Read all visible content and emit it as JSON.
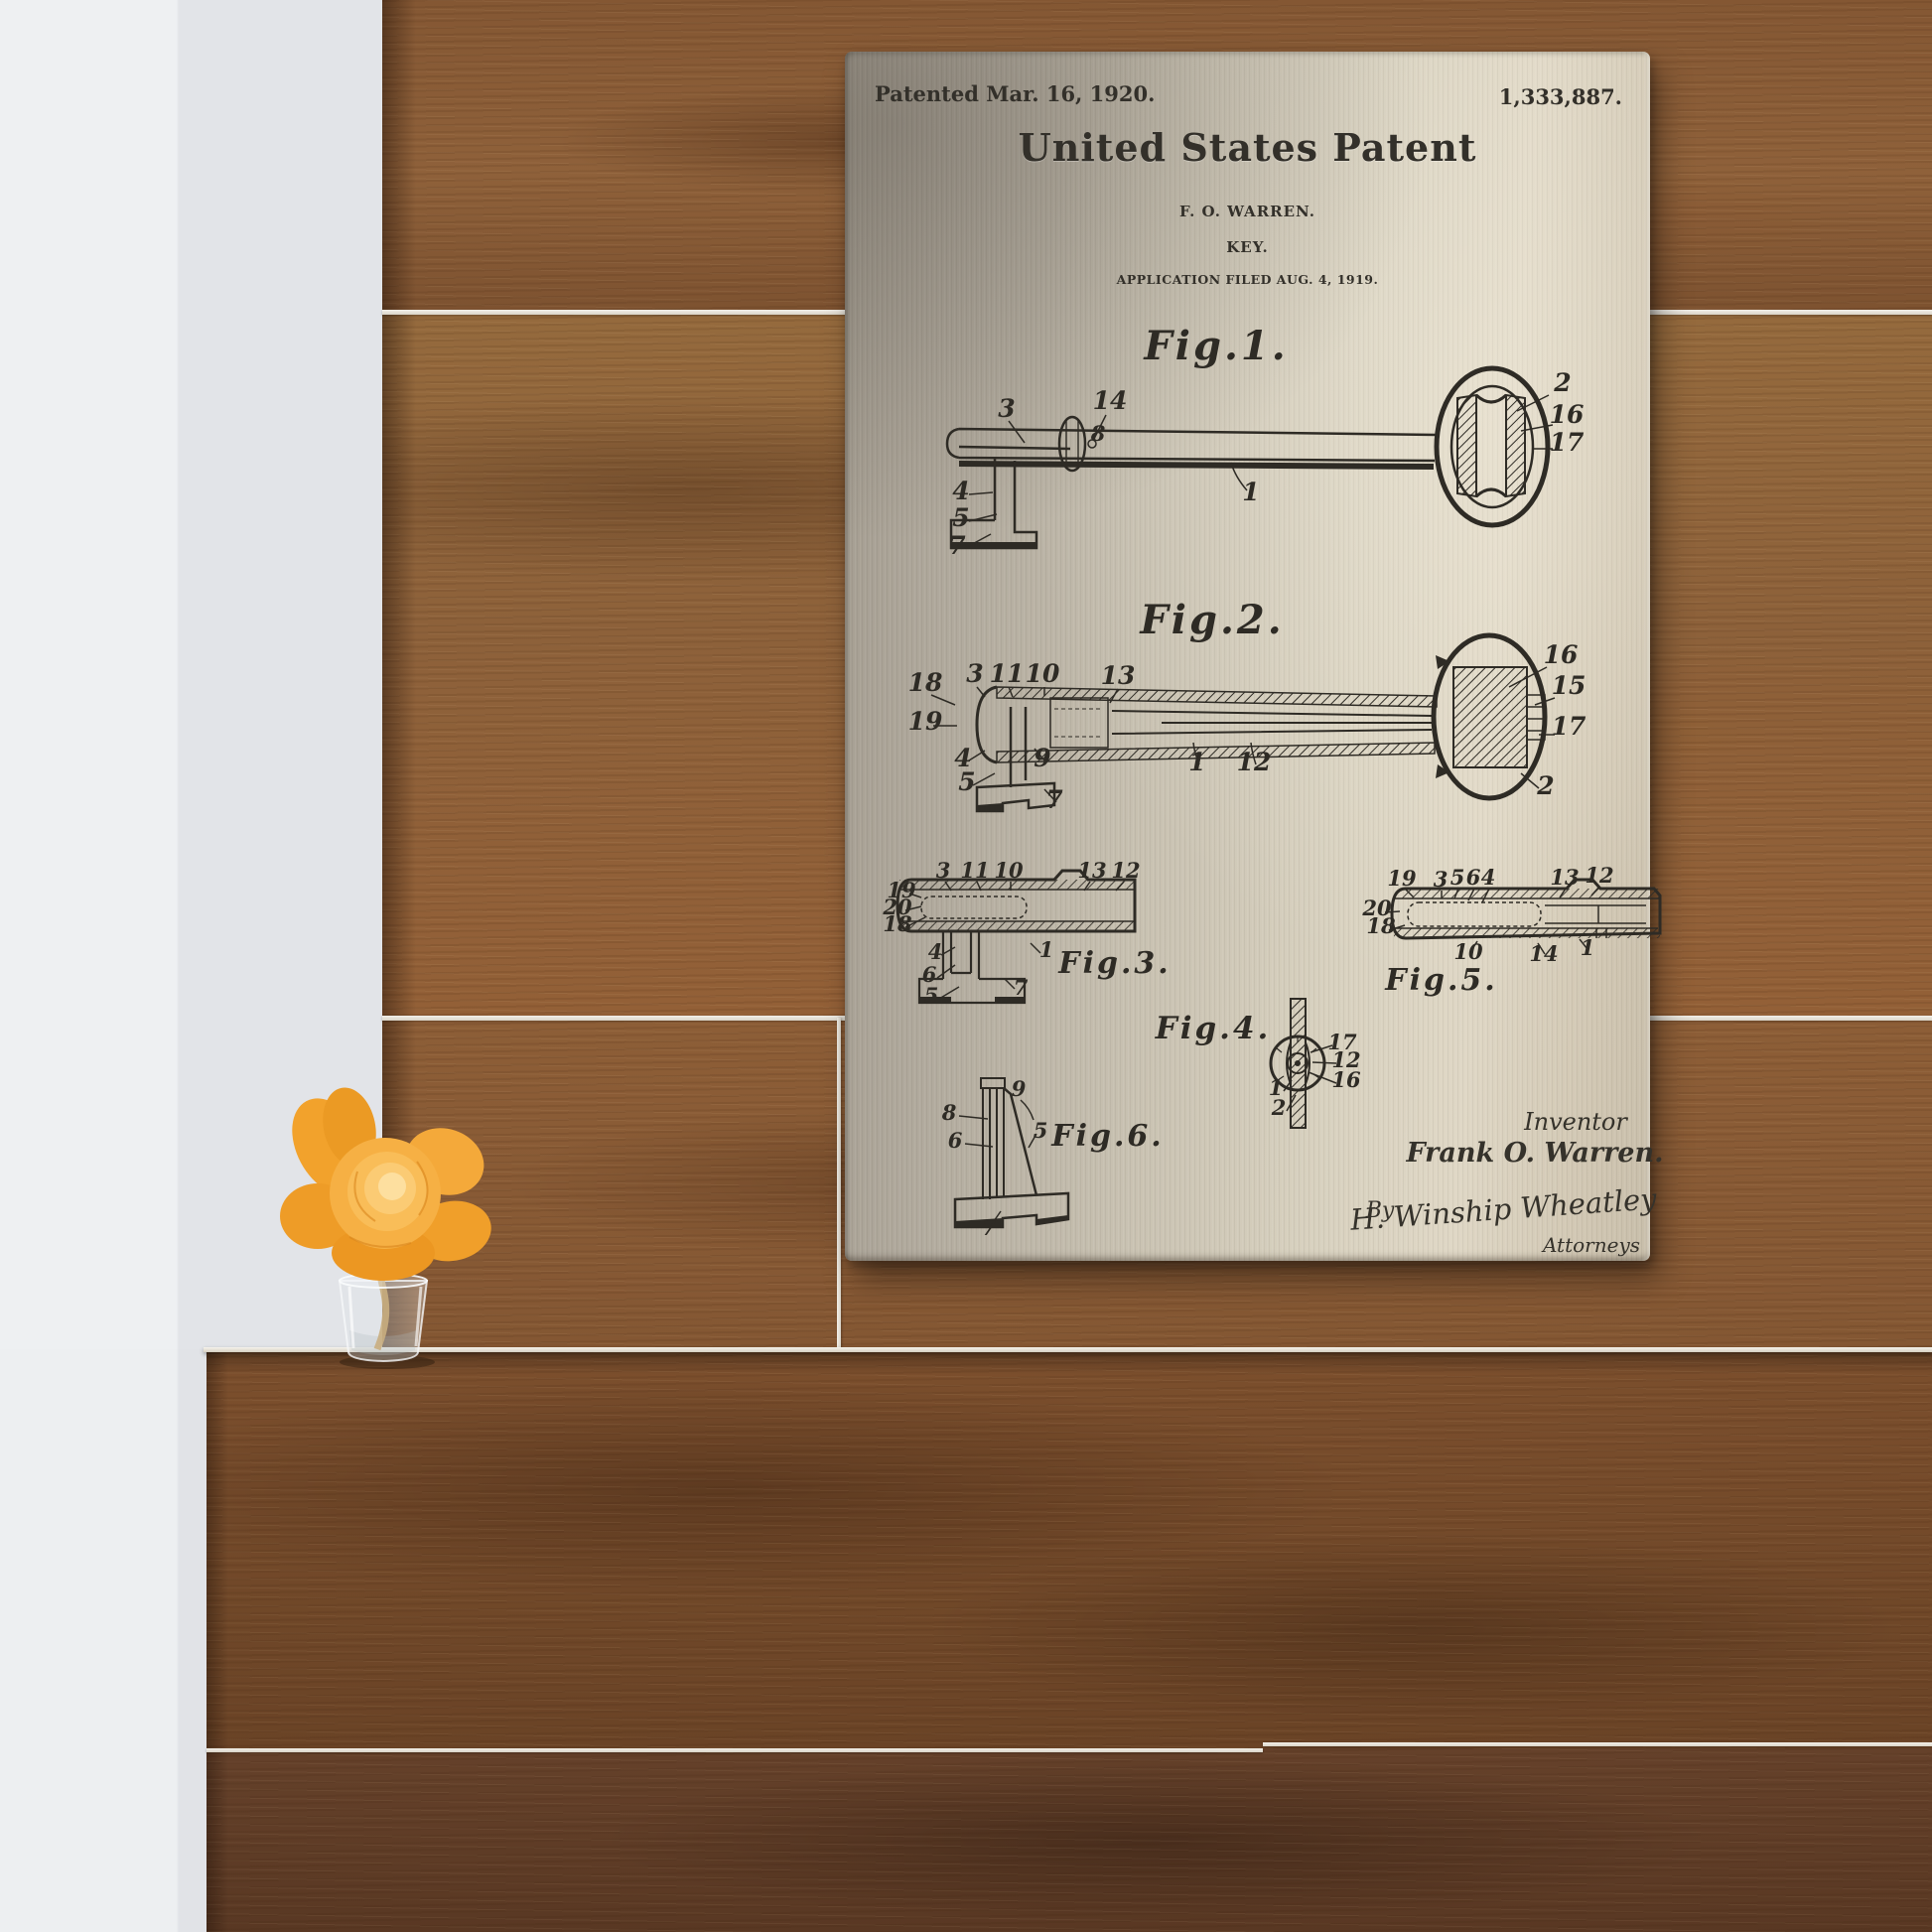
{
  "patent": {
    "header": {
      "patented_date": "Patented Mar. 16, 1920.",
      "patent_number": "1,333,887.",
      "title": "United States Patent",
      "inventor_name_caps": "F. O. WARREN.",
      "invention_title": "KEY.",
      "application_line": "APPLICATION FILED AUG. 4, 1919."
    },
    "figures": {
      "fig1": {
        "caption": "Fig.1.",
        "labels": [
          "3",
          "14",
          "8",
          "2",
          "16",
          "17",
          "1",
          "4",
          "5",
          "7"
        ]
      },
      "fig2": {
        "caption": "Fig.2.",
        "labels": [
          "18",
          "3",
          "11",
          "10",
          "13",
          "19",
          "16",
          "15",
          "17",
          "2",
          "4",
          "5",
          "9",
          "7",
          "1",
          "12"
        ]
      },
      "fig3": {
        "caption": "Fig.3.",
        "labels": [
          "3",
          "11",
          "10",
          "13",
          "12",
          "19",
          "20",
          "18",
          "4",
          "6",
          "5",
          "7",
          "1"
        ]
      },
      "fig4": {
        "caption": "Fig.4.",
        "labels": [
          "17",
          "12",
          "16",
          "1",
          "2"
        ]
      },
      "fig5": {
        "caption": "Fig.5.",
        "labels": [
          "19",
          "3",
          "5",
          "6",
          "4",
          "13",
          "12",
          "20",
          "18",
          "10",
          "14",
          "1"
        ]
      },
      "fig6": {
        "caption": "Fig.6.",
        "labels": [
          "9",
          "8",
          "6",
          "5",
          "7"
        ]
      }
    },
    "signature_block": {
      "inventor_caption": "Inventor",
      "inventor_name": "Frank O. Warren.",
      "by_label": "By",
      "attorney_signature": "H. Winship Wheatley",
      "attorneys_caption": "Attorneys"
    }
  },
  "palette": {
    "plate_metal_warm": "#d8d1bf",
    "plate_metal_cool": "#a39c90",
    "ink": "#2e2b25",
    "wood_light": "#956a3d",
    "wood_dark": "#593823",
    "wall_white": "#eef0f2",
    "flower_orange": "#f2a430"
  }
}
